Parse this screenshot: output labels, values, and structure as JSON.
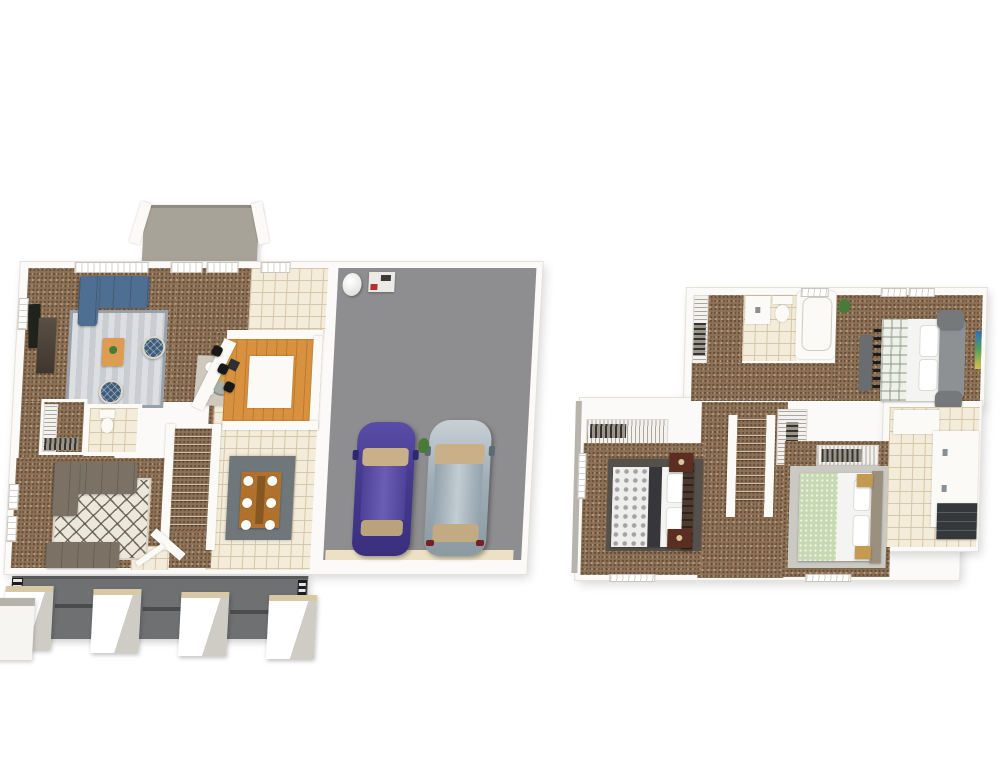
{
  "image_type": "3d-floor-plan-rendering",
  "title": "",
  "visible_text": [],
  "palette": {
    "wall": "#fbfaf7",
    "carpet": "#8d7156",
    "tile": "#f3ecda",
    "tile_line": "#d7c6a6",
    "wood_floor": "#d8913e",
    "wood_table": "#b0712c",
    "garage_floor": "#8e8e90",
    "porch": "#6e7072",
    "deck": "#a8a399",
    "rug_living": "#c9cdd1",
    "rug_family": "#ebe7db",
    "rug_dining": "#6f777a",
    "rug_nook": "#cfc9bd",
    "rug_bed2": "#55504b",
    "rug_bed3": "#cbc9c3",
    "sofa_blue": "#4e6f92",
    "pouf_navy": "#3d5c7a",
    "sofa_gray": "#7b7265",
    "car_purple": "#4a3d96",
    "car_silver": "#a7b3bb",
    "car_glass_tan": "#c9b088",
    "bed_green": "#c6d9b2",
    "headboard_gray": "#8d9194",
    "headboard_brown": "#4c3a2e",
    "nightstand_maroon": "#5c2e22",
    "nightstand_tan": "#c49a50",
    "cabinet_dark": "#35383b",
    "railing_black": "#1c1d1f",
    "stool_black": "#17181a",
    "door_strip": "#ece1c4",
    "plant_green": "#4a7a3a",
    "sink_dark": "#2c2f33",
    "tv_console": "#4a4038"
  },
  "floors": [
    {
      "id": "first-floor",
      "rooms": [
        {
          "name": "living-room",
          "furniture": [
            "blue-sectional-sofa",
            "area-rug",
            "coffee-table",
            "round-pouf",
            "round-pouf",
            "tv-console",
            "wall-art"
          ]
        },
        {
          "name": "dining-nook",
          "furniture": [
            "round-table",
            "four-place-settings"
          ]
        },
        {
          "name": "kitchen",
          "furniture": [
            "u-shaped-counter",
            "island",
            "sink",
            "bar-stool",
            "bar-stool",
            "bar-stool"
          ]
        },
        {
          "name": "breakfast-area",
          "furniture": []
        },
        {
          "name": "half-bathroom",
          "furniture": [
            "toilet"
          ]
        },
        {
          "name": "closet",
          "furniture": [
            "wire-shelving",
            "hanging-clothes"
          ]
        },
        {
          "name": "family-room",
          "furniture": [
            "gray-sectional-sofa",
            "gray-loveseat",
            "diamond-pattern-rug"
          ]
        },
        {
          "name": "staircase",
          "furniture": [
            "handrail"
          ]
        },
        {
          "name": "dining-room",
          "furniture": [
            "dining-table",
            "six-place-settings",
            "gray-rug"
          ]
        },
        {
          "name": "garage",
          "furniture": [
            "water-heater",
            "furnace",
            "purple-car",
            "silver-car",
            "potted-plant"
          ],
          "car_count": 2
        },
        {
          "name": "deck",
          "furniture": [
            "railings"
          ]
        },
        {
          "name": "front-porch",
          "furniture": [
            "pillar",
            "pillar",
            "pillar",
            "pillar",
            "black-railing"
          ],
          "pillar_count": 4
        }
      ]
    },
    {
      "id": "second-floor",
      "rooms": [
        {
          "name": "master-bedroom",
          "furniture": [
            "upholstered-bed",
            "bench",
            "pillows",
            "wall-tv",
            "potted-plant"
          ]
        },
        {
          "name": "master-bathroom",
          "furniture": [
            "vanity-sink",
            "toilet",
            "bathtub"
          ]
        },
        {
          "name": "walk-in-closet",
          "furniture": [
            "wire-shelving",
            "hanging-clothes"
          ]
        },
        {
          "name": "bedroom-2",
          "furniture": [
            "bed",
            "nightstand",
            "nightstand",
            "dark-rug",
            "closet-shelving"
          ]
        },
        {
          "name": "bedroom-3",
          "furniture": [
            "bed-green-bedding",
            "nightstand",
            "nightstand",
            "light-rug",
            "closet-shelving"
          ]
        },
        {
          "name": "hall-bathroom",
          "furniture": [
            "double-vanity",
            "dark-cabinet"
          ]
        },
        {
          "name": "hallway",
          "furniture": []
        },
        {
          "name": "staircase",
          "furniture": []
        }
      ]
    }
  ]
}
